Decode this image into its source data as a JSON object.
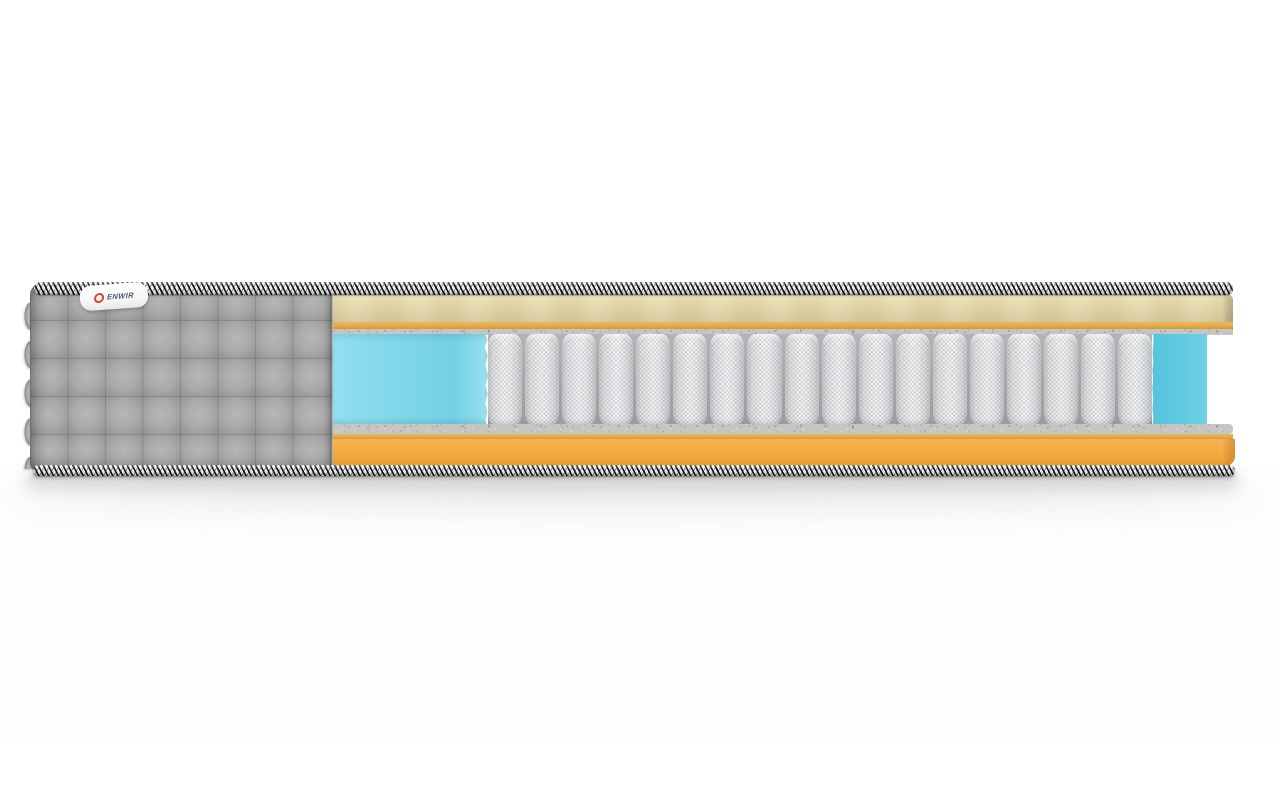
{
  "scene": {
    "description": "3D product render: cutaway cross-section of a pocket-spring mattress on a white background",
    "background": "#ffffff"
  },
  "label": {
    "brand": "ENWIR",
    "icon": "red-ring-icon"
  },
  "springs": {
    "count": 18
  },
  "layers": [
    {
      "id": "top-trim",
      "name": "braided edge rope trim",
      "pattern": "black-white diagonal"
    },
    {
      "id": "quilted-top-panel",
      "name": "quilted top comfort panel",
      "color": "#e3d8ac"
    },
    {
      "id": "top-foam-strip",
      "name": "thin foam strip",
      "color": "#e2ab4c"
    },
    {
      "id": "top-felt-pad",
      "name": "speckled felt pad",
      "color": "#c7c5c2"
    },
    {
      "id": "perimeter-foam-left",
      "name": "perimeter foam block",
      "color": "#7fd6e9"
    },
    {
      "id": "pocket-springs",
      "name": "pocket spring block",
      "color": "#f4f5f6"
    },
    {
      "id": "perimeter-foam-right",
      "name": "perimeter foam block",
      "color": "#5cc8e0"
    },
    {
      "id": "bottom-felt-pad",
      "name": "speckled felt pad",
      "color": "#c7c5c2"
    },
    {
      "id": "bottom-foam-strip",
      "name": "thin foam strip",
      "color": "#e2ab4c"
    },
    {
      "id": "base-foam-panel",
      "name": "base foam panel",
      "color": "#f4ac43"
    },
    {
      "id": "bottom-trim",
      "name": "braided edge rope trim",
      "pattern": "black-white diagonal"
    },
    {
      "id": "quilted-cover",
      "name": "gray quilted cover with scalloped edge",
      "color": "#a6a6a6"
    }
  ],
  "colors": {
    "cover_gray": "#a6a6a6",
    "cover_highlight": "#b7b7b7",
    "cover_shade": "#909090",
    "trim_light": "#efefef",
    "trim_dark": "#161616",
    "beige": "#e3d8ac",
    "beige_dark": "#d6c998",
    "mustard": "#e2ab4c",
    "felt": "#c7c5c2",
    "foam_blue": "#7fd6e9",
    "foam_blue_deep": "#5cc8e0",
    "spring_light": "#f4f5f6",
    "spring_gap": "#9b9c9f",
    "base_orange": "#f4ac43",
    "base_orange_deep": "#e89c30",
    "label_red": "#d84334",
    "label_blue": "#44557a",
    "shadow": "#9a9a9a"
  }
}
